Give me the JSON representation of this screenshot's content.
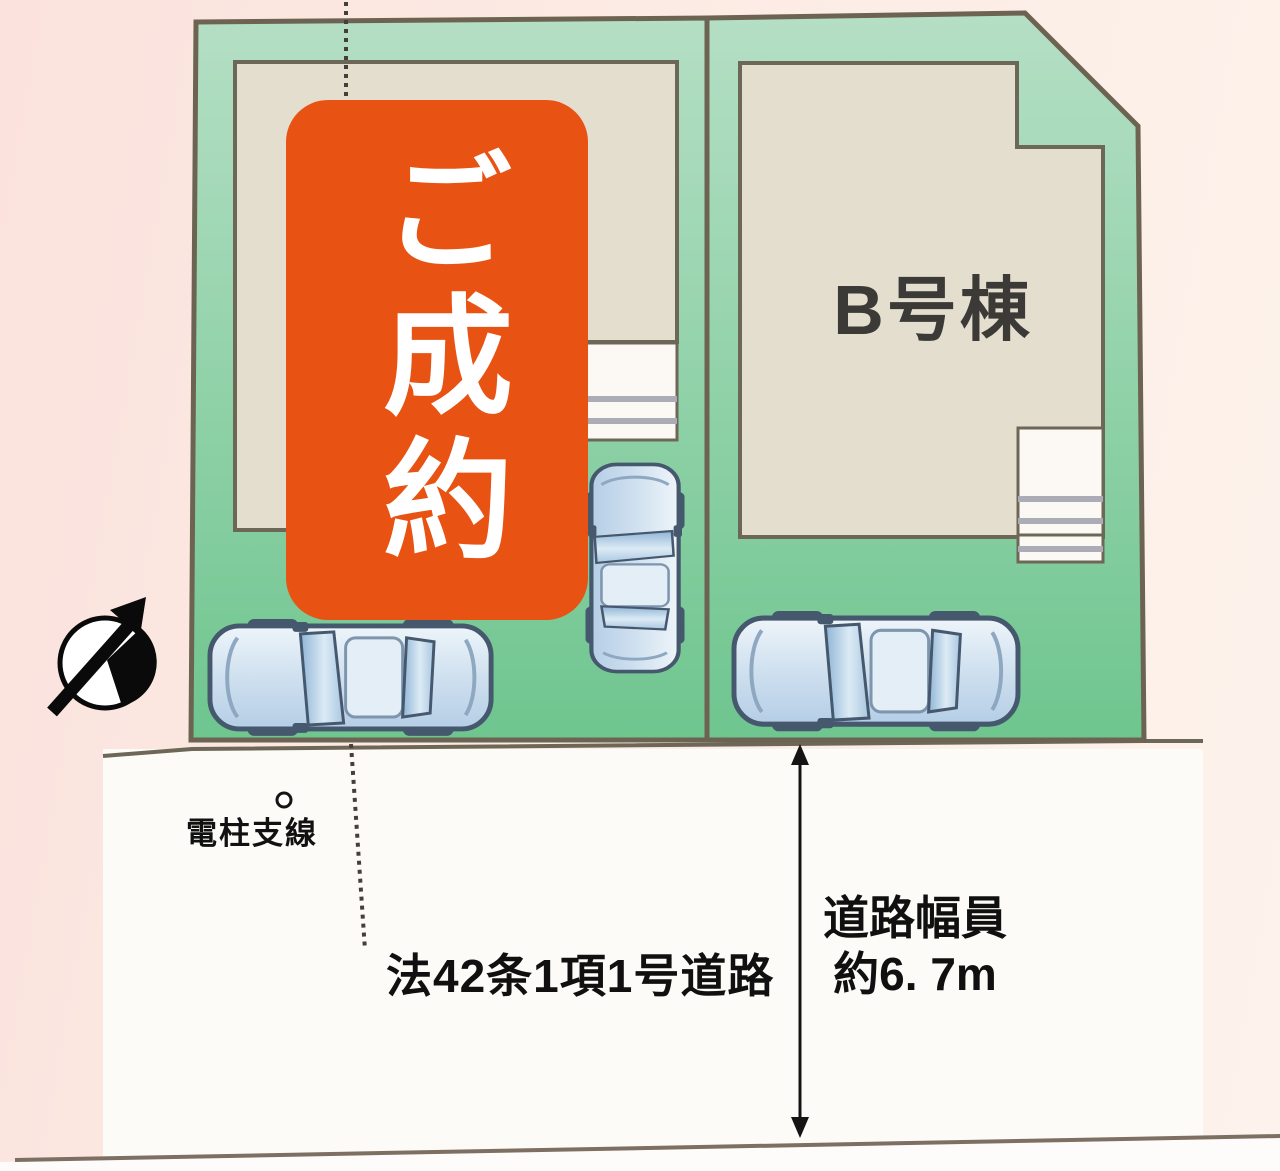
{
  "site_plan": {
    "sold_badge": {
      "label": "ご成約"
    },
    "building_b": {
      "label": "B号棟"
    },
    "road": {
      "designation_label": "法42条1項1号道路",
      "width_label": "道路幅員",
      "width_value": "約6. 7m"
    },
    "utility_pole": {
      "label": "電柱支線"
    },
    "icons": {
      "compass": "north-arrow",
      "utility_pole_marker": "pole-circle"
    },
    "colors": {
      "badge_orange": "#e85212",
      "badge_text": "#ffffff",
      "lot_green_top": "#b3dec4",
      "lot_green_bottom": "#6ec58e",
      "building_beige": "#e4decf",
      "outline_dark": "#6d6757",
      "road_white": "#fdfbf8",
      "background_pink": "#fbe6e0",
      "car_blue": "#c9dced",
      "label_dark": "#3b3a37"
    }
  }
}
